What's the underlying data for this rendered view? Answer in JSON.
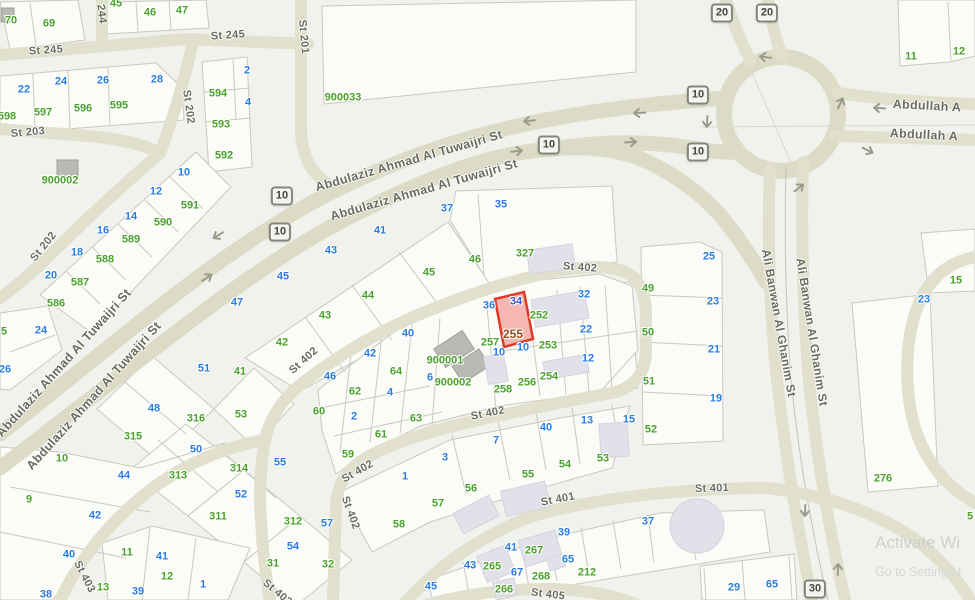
{
  "map": {
    "watermark": {
      "title": "Activate Wi",
      "subtitle": "Go to Settings t"
    },
    "highlight_parcel": {
      "number": "255",
      "unit": "34",
      "fill": "#f28076",
      "stroke": "#e03b28"
    },
    "colors": {
      "parcel_green": "#4aa22b",
      "unit_blue": "#2a7ce0",
      "highlight_red": "#e03b28",
      "road": "#dcdcc6",
      "background": "#f1f1ed"
    },
    "street_labels": [
      {
        "t": "St 245",
        "x": 46,
        "y": 51,
        "r": -4
      },
      {
        "t": "St 245",
        "x": 228,
        "y": 36,
        "r": -4
      },
      {
        "t": "244",
        "x": 101,
        "y": 14,
        "r": 83
      },
      {
        "t": "St 201",
        "x": 303,
        "y": 37,
        "r": 85
      },
      {
        "t": "St 203",
        "x": 28,
        "y": 133,
        "r": -5
      },
      {
        "t": "St 202",
        "x": 188,
        "y": 107,
        "r": 82
      },
      {
        "t": "St 202",
        "x": 44,
        "y": 247,
        "r": -51
      },
      {
        "t": "Abdulaziz Ahmad Al Tuwaijri St",
        "x": 409,
        "y": 161,
        "r": -16,
        "s": 12.5
      },
      {
        "t": "Abdulaziz Ahmad Al Tuwaijri St",
        "x": 424,
        "y": 190,
        "r": -16,
        "s": 12.5
      },
      {
        "t": "Abdulaziz Ahmad Al Tuwaijri St",
        "x": 64,
        "y": 363,
        "r": -48,
        "s": 12.5
      },
      {
        "t": "Abdulaziz Ahmad Al Tuwaijri St",
        "x": 94,
        "y": 396,
        "r": -48,
        "s": 12.5
      },
      {
        "t": "St 402",
        "x": 580,
        "y": 268,
        "r": 4
      },
      {
        "t": "St 402",
        "x": 488,
        "y": 414,
        "r": -11
      },
      {
        "t": "St 402",
        "x": 304,
        "y": 361,
        "r": -42
      },
      {
        "t": "St 402",
        "x": 358,
        "y": 472,
        "r": -30
      },
      {
        "t": "St 402",
        "x": 350,
        "y": 513,
        "r": 70
      },
      {
        "t": "St 402",
        "x": 277,
        "y": 593,
        "r": 40
      },
      {
        "t": "St 401",
        "x": 558,
        "y": 500,
        "r": -11
      },
      {
        "t": "St 401",
        "x": 712,
        "y": 489,
        "r": -2
      },
      {
        "t": "St 403",
        "x": 84,
        "y": 577,
        "r": 63
      },
      {
        "t": "St 405",
        "x": 548,
        "y": 595,
        "r": 7
      },
      {
        "t": "Ali Banwan Al Ghanim St",
        "x": 779,
        "y": 323,
        "r": 80,
        "s": 12
      },
      {
        "t": "Ali Banwan Al Ghanim St",
        "x": 812,
        "y": 332,
        "r": 81,
        "s": 12
      },
      {
        "t": "Abdullah A",
        "x": 927,
        "y": 106,
        "r": 3,
        "s": 12.5
      },
      {
        "t": "Abdullah A",
        "x": 924,
        "y": 135,
        "r": 3,
        "s": 12.5
      }
    ],
    "route_shields": [
      {
        "n": "10",
        "x": 282,
        "y": 196
      },
      {
        "n": "10",
        "x": 280,
        "y": 232
      },
      {
        "n": "10",
        "x": 549,
        "y": 145
      },
      {
        "n": "10",
        "x": 698,
        "y": 95
      },
      {
        "n": "10",
        "x": 698,
        "y": 152
      },
      {
        "n": "20",
        "x": 722,
        "y": 13
      },
      {
        "n": "20",
        "x": 767,
        "y": 13
      },
      {
        "n": "30",
        "x": 815,
        "y": 589
      }
    ],
    "arrows": [
      {
        "x": 217,
        "y": 236,
        "r": 148
      },
      {
        "x": 208,
        "y": 277,
        "r": -34
      },
      {
        "x": 528,
        "y": 121,
        "r": 174
      },
      {
        "x": 518,
        "y": 151,
        "r": -6
      },
      {
        "x": 638,
        "y": 113,
        "r": 177
      },
      {
        "x": 632,
        "y": 142,
        "r": -3
      },
      {
        "x": 707,
        "y": 123,
        "r": 93
      },
      {
        "x": 764,
        "y": 57,
        "r": 187
      },
      {
        "x": 841,
        "y": 102,
        "r": -65
      },
      {
        "x": 869,
        "y": 151,
        "r": 27
      },
      {
        "x": 800,
        "y": 187,
        "r": -38
      },
      {
        "x": 878,
        "y": 108,
        "r": 183
      },
      {
        "x": 805,
        "y": 512,
        "r": 92
      },
      {
        "x": 838,
        "y": 568,
        "r": -88
      }
    ],
    "parcel_labels": [
      {
        "t": "70",
        "x": 11,
        "y": 21,
        "c": "g"
      },
      {
        "t": "69",
        "x": 49,
        "y": 24,
        "c": "g"
      },
      {
        "t": "45",
        "x": 116,
        "y": 4,
        "c": "g"
      },
      {
        "t": "46",
        "x": 150,
        "y": 13,
        "c": "g"
      },
      {
        "t": "47",
        "x": 182,
        "y": 11,
        "c": "g"
      },
      {
        "t": "598",
        "x": 7,
        "y": 117,
        "c": "g"
      },
      {
        "t": "597",
        "x": 43,
        "y": 113,
        "c": "g"
      },
      {
        "t": "596",
        "x": 83,
        "y": 109,
        "c": "g"
      },
      {
        "t": "595",
        "x": 119,
        "y": 106,
        "c": "g"
      },
      {
        "t": "22",
        "x": 24,
        "y": 90,
        "c": "b"
      },
      {
        "t": "24",
        "x": 61,
        "y": 82,
        "c": "b"
      },
      {
        "t": "26",
        "x": 103,
        "y": 81,
        "c": "b"
      },
      {
        "t": "28",
        "x": 157,
        "y": 80,
        "c": "b"
      },
      {
        "t": "594",
        "x": 218,
        "y": 94,
        "c": "g"
      },
      {
        "t": "593",
        "x": 221,
        "y": 125,
        "c": "g"
      },
      {
        "t": "592",
        "x": 224,
        "y": 156,
        "c": "g"
      },
      {
        "t": "2",
        "x": 247,
        "y": 71,
        "c": "b"
      },
      {
        "t": "4",
        "x": 248,
        "y": 103,
        "c": "b"
      },
      {
        "t": "900002",
        "x": 60,
        "y": 181,
        "c": "g"
      },
      {
        "t": "900033",
        "x": 343,
        "y": 98,
        "c": "g"
      },
      {
        "t": "10",
        "x": 184,
        "y": 173,
        "c": "b"
      },
      {
        "t": "12",
        "x": 156,
        "y": 192,
        "c": "b"
      },
      {
        "t": "14",
        "x": 131,
        "y": 217,
        "c": "b"
      },
      {
        "t": "16",
        "x": 103,
        "y": 231,
        "c": "b"
      },
      {
        "t": "18",
        "x": 77,
        "y": 253,
        "c": "b"
      },
      {
        "t": "20",
        "x": 51,
        "y": 276,
        "c": "b"
      },
      {
        "t": "591",
        "x": 190,
        "y": 206,
        "c": "g"
      },
      {
        "t": "590",
        "x": 163,
        "y": 223,
        "c": "g"
      },
      {
        "t": "589",
        "x": 131,
        "y": 240,
        "c": "g"
      },
      {
        "t": "588",
        "x": 105,
        "y": 260,
        "c": "g"
      },
      {
        "t": "587",
        "x": 80,
        "y": 283,
        "c": "g"
      },
      {
        "t": "586",
        "x": 56,
        "y": 304,
        "c": "g"
      },
      {
        "t": "5",
        "x": 4,
        "y": 332,
        "c": "g"
      },
      {
        "t": "24",
        "x": 41,
        "y": 331,
        "c": "b"
      },
      {
        "t": "26",
        "x": 5,
        "y": 370,
        "c": "b"
      },
      {
        "t": "11",
        "x": 911,
        "y": 57,
        "c": "g"
      },
      {
        "t": "12",
        "x": 959,
        "y": 52,
        "c": "g"
      },
      {
        "t": "47",
        "x": 237,
        "y": 303,
        "c": "b"
      },
      {
        "t": "45",
        "x": 283,
        "y": 277,
        "c": "b"
      },
      {
        "t": "43",
        "x": 331,
        "y": 251,
        "c": "b"
      },
      {
        "t": "41",
        "x": 380,
        "y": 231,
        "c": "b"
      },
      {
        "t": "37",
        "x": 447,
        "y": 209,
        "c": "b"
      },
      {
        "t": "35",
        "x": 501,
        "y": 205,
        "c": "b"
      },
      {
        "t": "42",
        "x": 282,
        "y": 343,
        "c": "g"
      },
      {
        "t": "43",
        "x": 325,
        "y": 316,
        "c": "g"
      },
      {
        "t": "44",
        "x": 368,
        "y": 296,
        "c": "g"
      },
      {
        "t": "45",
        "x": 429,
        "y": 273,
        "c": "g"
      },
      {
        "t": "46",
        "x": 475,
        "y": 260,
        "c": "g"
      },
      {
        "t": "327",
        "x": 525,
        "y": 254,
        "c": "g"
      },
      {
        "t": "36",
        "x": 489,
        "y": 306,
        "c": "b"
      },
      {
        "t": "40",
        "x": 408,
        "y": 334,
        "c": "b"
      },
      {
        "t": "34",
        "x": 516,
        "y": 302,
        "c": "i"
      },
      {
        "t": "255",
        "x": 513,
        "y": 334,
        "c": "n"
      },
      {
        "t": "252",
        "x": 539,
        "y": 316,
        "c": "g"
      },
      {
        "t": "32",
        "x": 584,
        "y": 295,
        "c": "b"
      },
      {
        "t": "22",
        "x": 586,
        "y": 330,
        "c": "b"
      },
      {
        "t": "257",
        "x": 490,
        "y": 343,
        "c": "g"
      },
      {
        "t": "10",
        "x": 499,
        "y": 353,
        "c": "b"
      },
      {
        "t": "10",
        "x": 523,
        "y": 348,
        "c": "b"
      },
      {
        "t": "253",
        "x": 548,
        "y": 346,
        "c": "g"
      },
      {
        "t": "12",
        "x": 588,
        "y": 359,
        "c": "b"
      },
      {
        "t": "900001",
        "x": 445,
        "y": 361,
        "c": "g"
      },
      {
        "t": "900002",
        "x": 453,
        "y": 383,
        "c": "g"
      },
      {
        "t": "258",
        "x": 503,
        "y": 390,
        "c": "g"
      },
      {
        "t": "256",
        "x": 527,
        "y": 383,
        "c": "g"
      },
      {
        "t": "254",
        "x": 549,
        "y": 377,
        "c": "g"
      },
      {
        "t": "25",
        "x": 709,
        "y": 257,
        "c": "b"
      },
      {
        "t": "23",
        "x": 713,
        "y": 302,
        "c": "b"
      },
      {
        "t": "21",
        "x": 714,
        "y": 350,
        "c": "b"
      },
      {
        "t": "19",
        "x": 716,
        "y": 399,
        "c": "b"
      },
      {
        "t": "49",
        "x": 648,
        "y": 289,
        "c": "g"
      },
      {
        "t": "50",
        "x": 648,
        "y": 333,
        "c": "g"
      },
      {
        "t": "51",
        "x": 649,
        "y": 382,
        "c": "g"
      },
      {
        "t": "52",
        "x": 651,
        "y": 430,
        "c": "g"
      },
      {
        "t": "15",
        "x": 956,
        "y": 281,
        "c": "g"
      },
      {
        "t": "23",
        "x": 924,
        "y": 300,
        "c": "b"
      },
      {
        "t": "276",
        "x": 883,
        "y": 479,
        "c": "g"
      },
      {
        "t": "5",
        "x": 970,
        "y": 517,
        "c": "g"
      },
      {
        "t": "51",
        "x": 204,
        "y": 369,
        "c": "b"
      },
      {
        "t": "41",
        "x": 240,
        "y": 372,
        "c": "g"
      },
      {
        "t": "48",
        "x": 154,
        "y": 409,
        "c": "b"
      },
      {
        "t": "316",
        "x": 196,
        "y": 419,
        "c": "g"
      },
      {
        "t": "53",
        "x": 241,
        "y": 415,
        "c": "g"
      },
      {
        "t": "315",
        "x": 133,
        "y": 437,
        "c": "g"
      },
      {
        "t": "50",
        "x": 196,
        "y": 450,
        "c": "b"
      },
      {
        "t": "10",
        "x": 62,
        "y": 459,
        "c": "g"
      },
      {
        "t": "44",
        "x": 124,
        "y": 476,
        "c": "b"
      },
      {
        "t": "313",
        "x": 178,
        "y": 476,
        "c": "g"
      },
      {
        "t": "314",
        "x": 239,
        "y": 469,
        "c": "g"
      },
      {
        "t": "52",
        "x": 241,
        "y": 495,
        "c": "b"
      },
      {
        "t": "9",
        "x": 29,
        "y": 500,
        "c": "g"
      },
      {
        "t": "42",
        "x": 95,
        "y": 516,
        "c": "b"
      },
      {
        "t": "311",
        "x": 218,
        "y": 517,
        "c": "g"
      },
      {
        "t": "312",
        "x": 293,
        "y": 522,
        "c": "g"
      },
      {
        "t": "57",
        "x": 327,
        "y": 524,
        "c": "b"
      },
      {
        "t": "40",
        "x": 69,
        "y": 555,
        "c": "b"
      },
      {
        "t": "38",
        "x": 46,
        "y": 595,
        "c": "b"
      },
      {
        "t": "11",
        "x": 127,
        "y": 553,
        "c": "g"
      },
      {
        "t": "41",
        "x": 162,
        "y": 557,
        "c": "b"
      },
      {
        "t": "12",
        "x": 167,
        "y": 577,
        "c": "g"
      },
      {
        "t": "13",
        "x": 103,
        "y": 588,
        "c": "g"
      },
      {
        "t": "39",
        "x": 138,
        "y": 592,
        "c": "b"
      },
      {
        "t": "1",
        "x": 203,
        "y": 585,
        "c": "b"
      },
      {
        "t": "54",
        "x": 293,
        "y": 547,
        "c": "b"
      },
      {
        "t": "31",
        "x": 273,
        "y": 564,
        "c": "g"
      },
      {
        "t": "32",
        "x": 328,
        "y": 565,
        "c": "g"
      },
      {
        "t": "42",
        "x": 370,
        "y": 354,
        "c": "b"
      },
      {
        "t": "46",
        "x": 330,
        "y": 377,
        "c": "b"
      },
      {
        "t": "64",
        "x": 396,
        "y": 372,
        "c": "g"
      },
      {
        "t": "62",
        "x": 355,
        "y": 392,
        "c": "g"
      },
      {
        "t": "4",
        "x": 390,
        "y": 393,
        "c": "b"
      },
      {
        "t": "6",
        "x": 430,
        "y": 378,
        "c": "b"
      },
      {
        "t": "60",
        "x": 319,
        "y": 412,
        "c": "g"
      },
      {
        "t": "2",
        "x": 354,
        "y": 417,
        "c": "b"
      },
      {
        "t": "63",
        "x": 416,
        "y": 419,
        "c": "g"
      },
      {
        "t": "61",
        "x": 381,
        "y": 435,
        "c": "g"
      },
      {
        "t": "59",
        "x": 348,
        "y": 455,
        "c": "g"
      },
      {
        "t": "55",
        "x": 280,
        "y": 463,
        "c": "b"
      },
      {
        "t": "3",
        "x": 445,
        "y": 458,
        "c": "b"
      },
      {
        "t": "1",
        "x": 405,
        "y": 477,
        "c": "b"
      },
      {
        "t": "7",
        "x": 496,
        "y": 441,
        "c": "b"
      },
      {
        "t": "40",
        "x": 546,
        "y": 428,
        "c": "b"
      },
      {
        "t": "13",
        "x": 587,
        "y": 421,
        "c": "b"
      },
      {
        "t": "15",
        "x": 629,
        "y": 420,
        "c": "b"
      },
      {
        "t": "53",
        "x": 603,
        "y": 459,
        "c": "g"
      },
      {
        "t": "54",
        "x": 565,
        "y": 465,
        "c": "g"
      },
      {
        "t": "55",
        "x": 528,
        "y": 475,
        "c": "g"
      },
      {
        "t": "56",
        "x": 471,
        "y": 489,
        "c": "g"
      },
      {
        "t": "57",
        "x": 438,
        "y": 504,
        "c": "g"
      },
      {
        "t": "58",
        "x": 399,
        "y": 525,
        "c": "g"
      },
      {
        "t": "39",
        "x": 564,
        "y": 533,
        "c": "b"
      },
      {
        "t": "37",
        "x": 648,
        "y": 522,
        "c": "b"
      },
      {
        "t": "41",
        "x": 511,
        "y": 548,
        "c": "b"
      },
      {
        "t": "267",
        "x": 534,
        "y": 551,
        "c": "g"
      },
      {
        "t": "65",
        "x": 568,
        "y": 560,
        "c": "b"
      },
      {
        "t": "43",
        "x": 470,
        "y": 566,
        "c": "b"
      },
      {
        "t": "265",
        "x": 492,
        "y": 567,
        "c": "g"
      },
      {
        "t": "67",
        "x": 517,
        "y": 573,
        "c": "b"
      },
      {
        "t": "268",
        "x": 541,
        "y": 577,
        "c": "g"
      },
      {
        "t": "212",
        "x": 587,
        "y": 573,
        "c": "g"
      },
      {
        "t": "45",
        "x": 431,
        "y": 587,
        "c": "b"
      },
      {
        "t": "266",
        "x": 504,
        "y": 590,
        "c": "g"
      },
      {
        "t": "29",
        "x": 734,
        "y": 588,
        "c": "b"
      },
      {
        "t": "65",
        "x": 772,
        "y": 585,
        "c": "b"
      }
    ]
  }
}
